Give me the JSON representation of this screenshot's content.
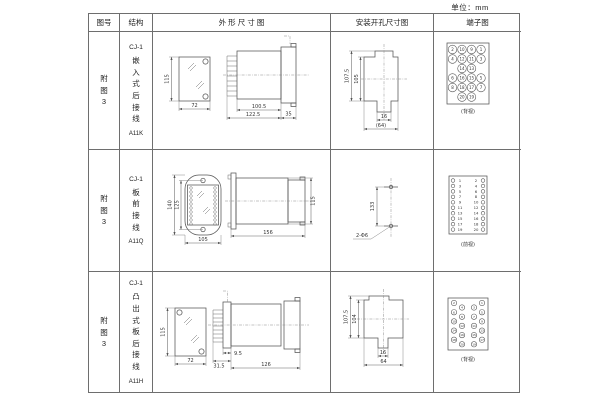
{
  "unit_label": "单位：mm",
  "headers": {
    "fig": "图号",
    "structure": "结构",
    "outline": "外 形 尺 寸 图",
    "mounting": "安装开孔尺寸图",
    "terminal": "端子图"
  },
  "rows": [
    {
      "fig": "附图3",
      "model": "CJ-1",
      "desc": "嵌入式后接线",
      "code": "A11K",
      "outline": {
        "h": "115",
        "w": "72",
        "d_body": "100.5",
        "d_total": "122.5",
        "flange": "35"
      },
      "mount": {
        "h_outer": "107.5",
        "h_inner": "105",
        "slot_w": "16",
        "cutout_w": "(64)"
      },
      "terminal": {
        "view": "(背视)"
      }
    },
    {
      "fig": "附图3",
      "model": "CJ-1",
      "desc": "板前接线",
      "code": "A11Q",
      "outline": {
        "h_outer": "140",
        "h_holes": "125",
        "w": "105",
        "depth": "156",
        "side_h": "115"
      },
      "mount": {
        "spacing": "133",
        "holes": "2-Φ6"
      },
      "terminal": {
        "view": "(前视)"
      }
    },
    {
      "fig": "附图3",
      "model": "CJ-1",
      "desc": "凸出式板后接线",
      "code": "A11H",
      "outline": {
        "h": "115",
        "w": "72",
        "d1": "31.5",
        "d2": "9.5",
        "d3": "126"
      },
      "mount": {
        "h_outer": "107.5",
        "h_inner": "104",
        "slot_w": "16",
        "cutout_w": "64"
      },
      "terminal": {
        "view": "(背视)"
      }
    }
  ],
  "terminals": {
    "back_grid": {
      "rows": [
        [
          "2",
          "10",
          "9",
          "1"
        ],
        [
          "4",
          "12",
          "11",
          "3"
        ],
        [
          "",
          "14",
          "13",
          ""
        ],
        [
          "6",
          "16",
          "15",
          "5"
        ],
        [
          "8",
          "18",
          "17",
          "7"
        ],
        [
          "",
          "20",
          "19",
          ""
        ]
      ]
    },
    "front_cols": {
      "left": [
        "1",
        "3",
        "5",
        "7",
        "9",
        "11",
        "13",
        "15",
        "17",
        "19"
      ],
      "right": [
        "2",
        "4",
        "6",
        "8",
        "10",
        "12",
        "14",
        "16",
        "18",
        "20"
      ]
    },
    "back_stagger": {
      "left_outer": [
        "2",
        "6",
        "10",
        "14",
        "18"
      ],
      "left_inner": [
        "4",
        "8",
        "12",
        "16",
        "20"
      ],
      "right_inner": [
        "3",
        "7",
        "11",
        "15",
        "19"
      ],
      "right_outer": [
        "1",
        "5",
        "9",
        "13",
        "17"
      ]
    }
  }
}
